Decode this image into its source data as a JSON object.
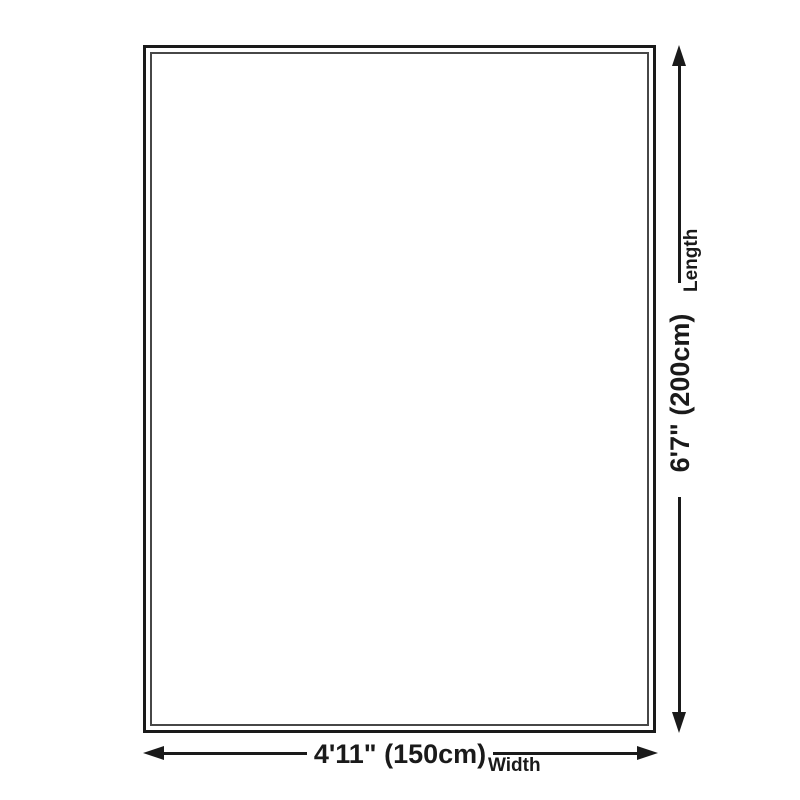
{
  "diagram": {
    "type": "product-size-diagram",
    "background": "#ffffff",
    "line_color": "#1a1a1a",
    "rect": {
      "fill": "#ffffff",
      "outer_border_color": "#1a1a1a",
      "inner_border_color": "#474747"
    },
    "width_dim": {
      "value": "4'11\" (150cm)",
      "label": "Width"
    },
    "length_dim": {
      "value": "6'7\" (200cm)",
      "label": "Length"
    }
  }
}
